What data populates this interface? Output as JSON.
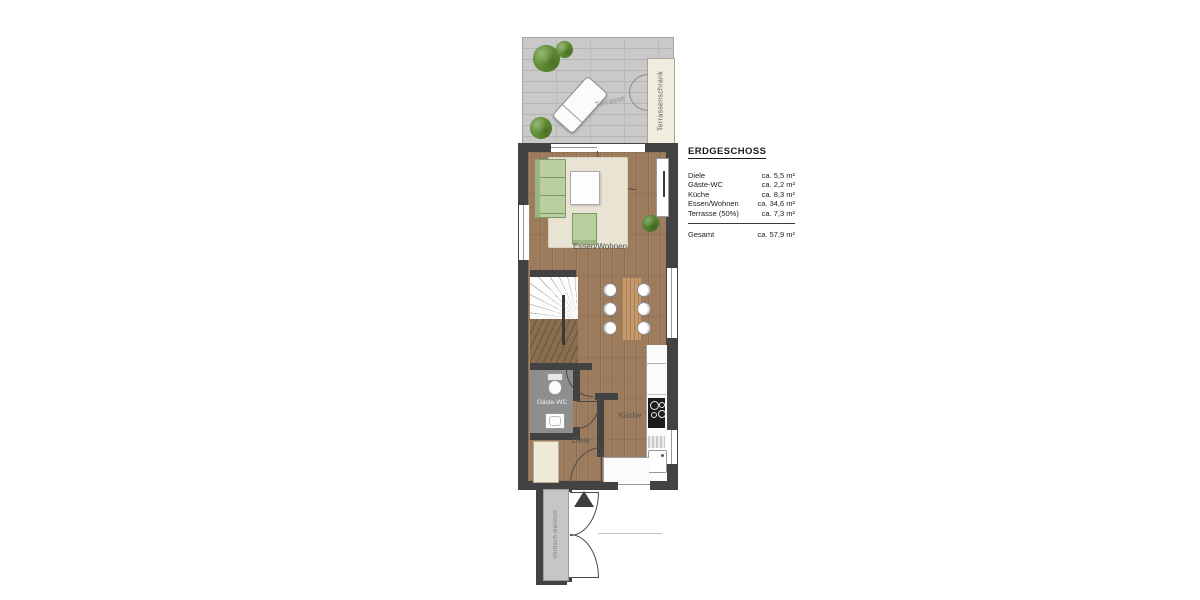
{
  "legend": {
    "title": "ERDGESCHOSS",
    "rows": [
      {
        "label": "Diele",
        "value": "ca. 5,5 m²"
      },
      {
        "label": "Gäste-WC",
        "value": "ca. 2,2 m²"
      },
      {
        "label": "Küche",
        "value": "ca. 8,3 m²"
      },
      {
        "label": "Essen/Wohnen",
        "value": "ca. 34,6 m²"
      },
      {
        "label": "Terrasse (50%)",
        "value": "ca. 7,3 m²"
      }
    ],
    "total": {
      "label": "Gesamt",
      "value": "ca. 57,9 m²"
    }
  },
  "rooms": {
    "terrasse": "Terrasse",
    "terrassenschrank": "Terrassenschrank",
    "essen_wohnen": "Essen/Wohnen",
    "kueche": "Küche",
    "diele": "Diele",
    "gaeste_wc": "Gäste-WC",
    "vordach": "Vordach-Bereich"
  },
  "colors": {
    "wall": "#424242",
    "wood_floor": "#9c7c5c",
    "terrace_tile": "#c9c9c9",
    "furniture_green": "#b9cfa0",
    "rug": "#e9e3d4",
    "wc_floor": "#8e8e8e",
    "cabinet_cream": "#f1edde",
    "plant_green": "#5f8c33"
  }
}
